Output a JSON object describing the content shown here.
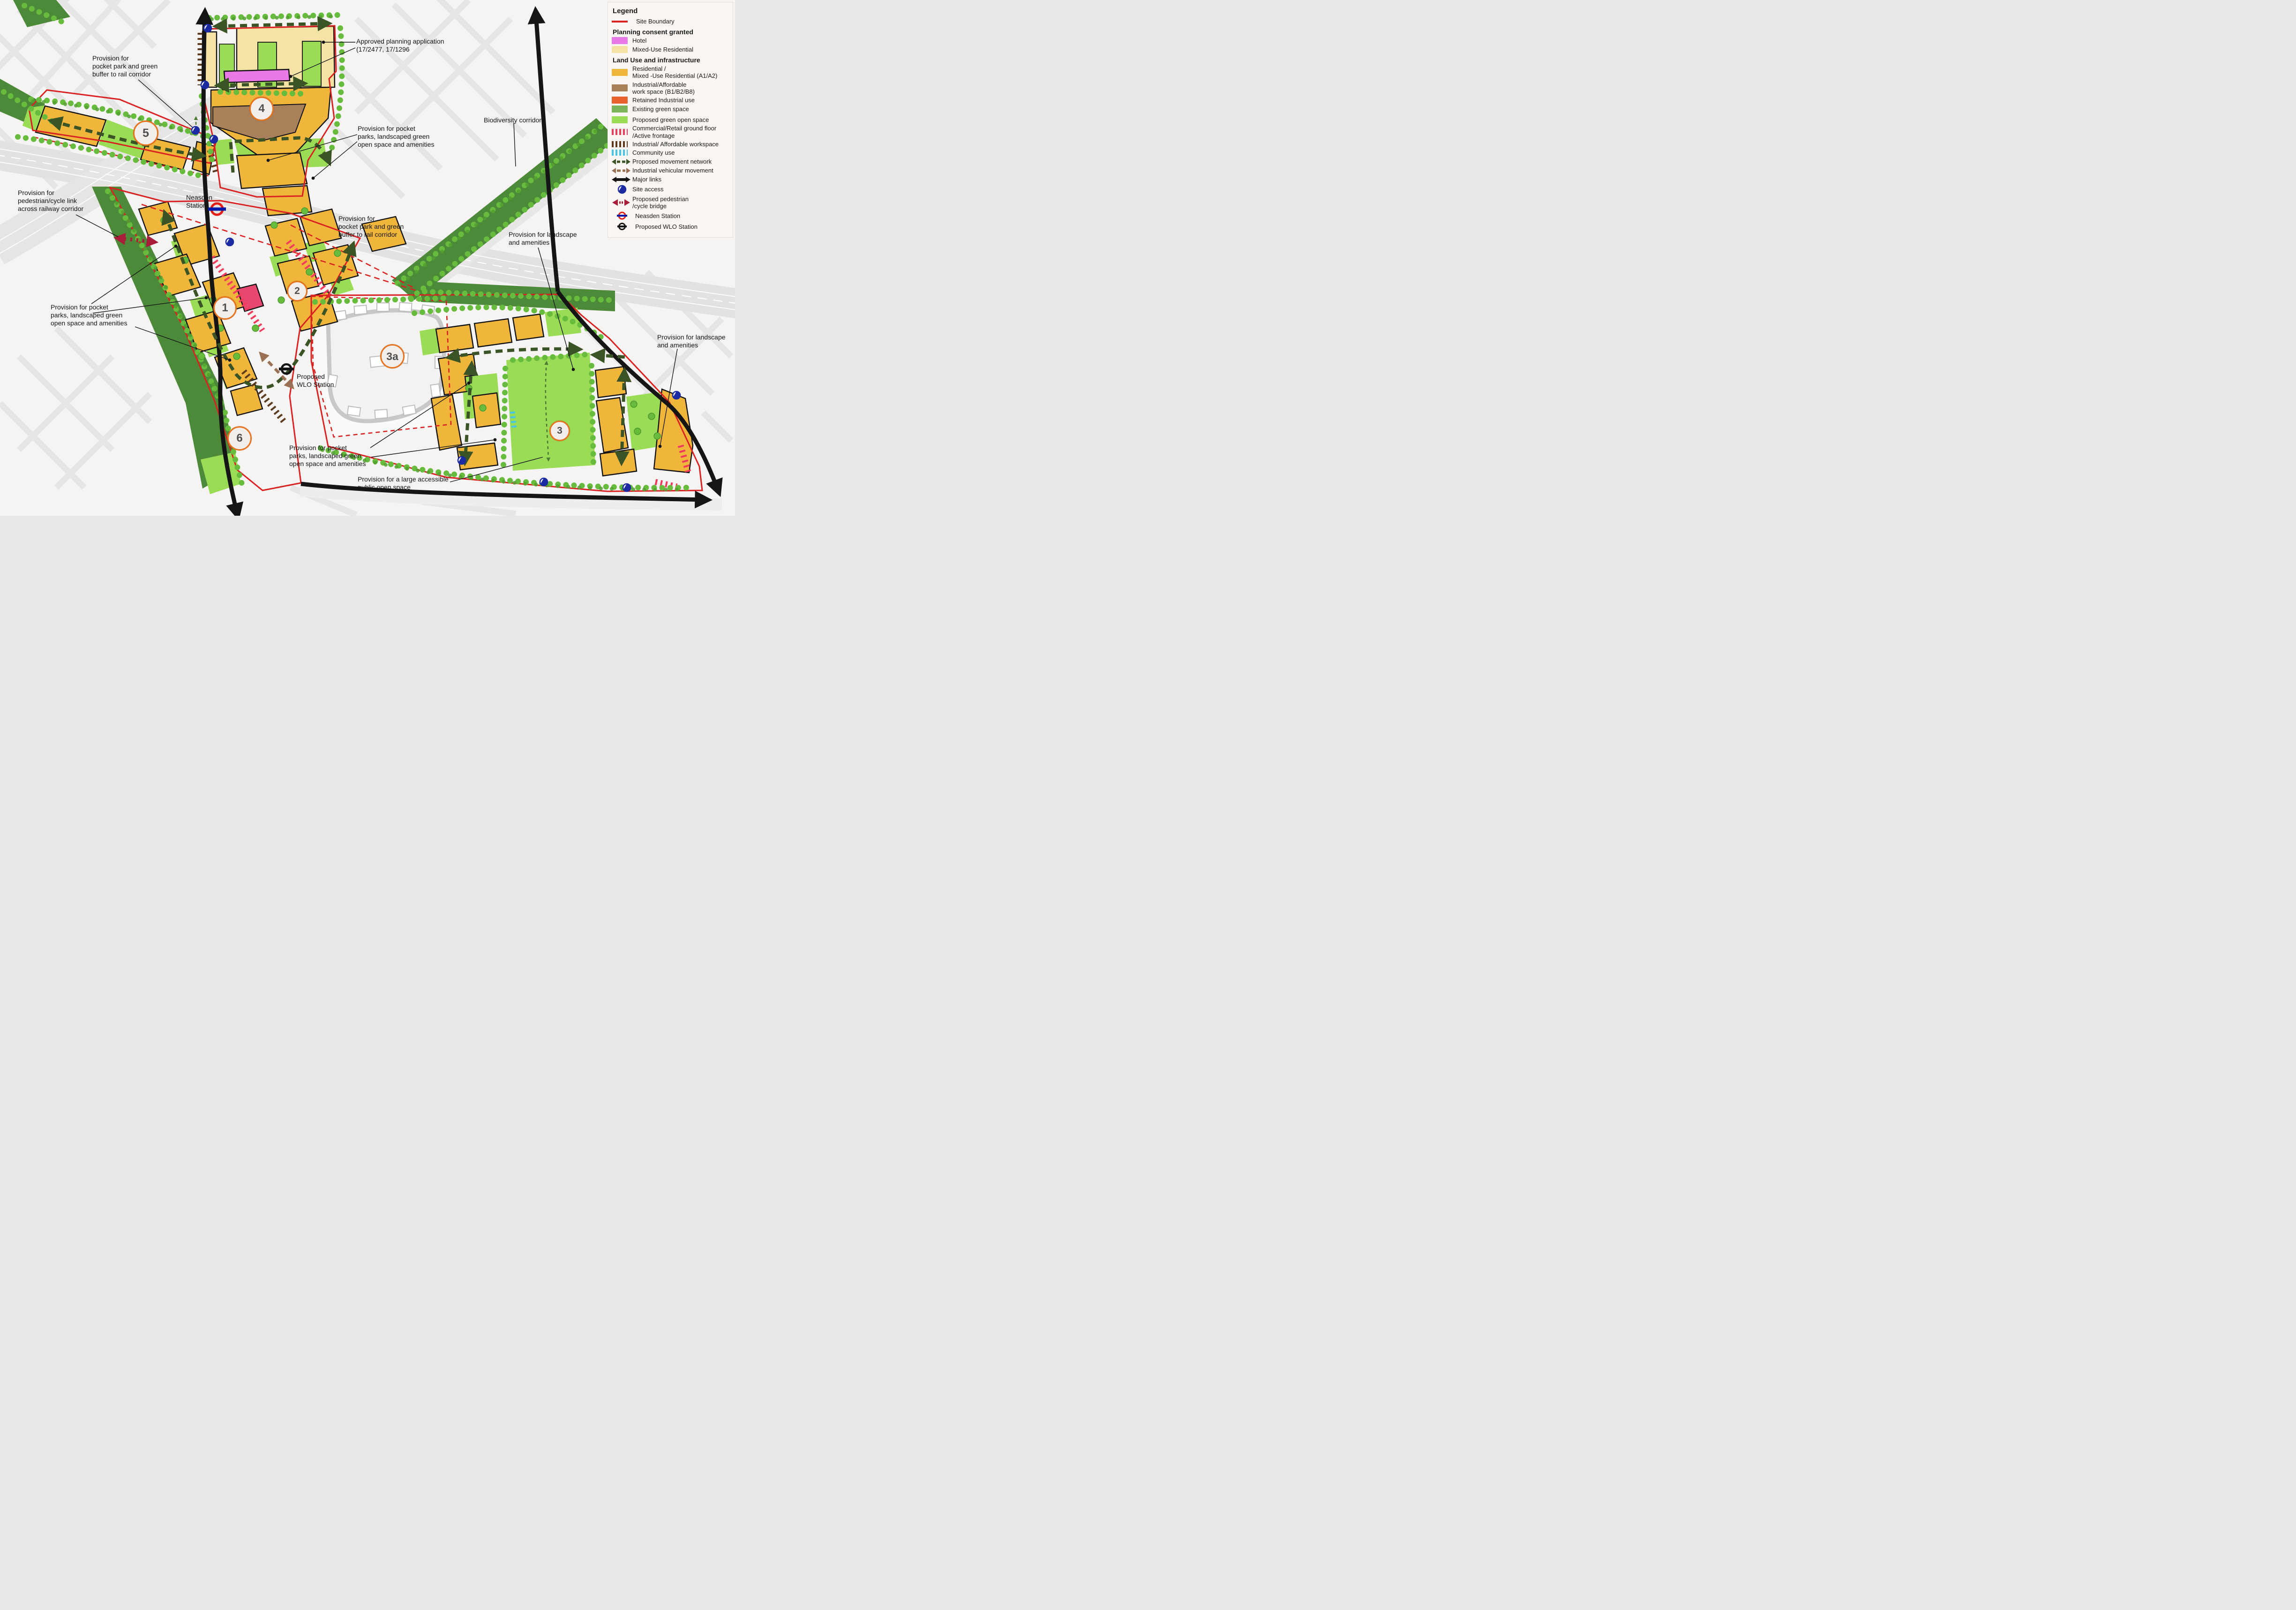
{
  "legend": {
    "title": "Legend",
    "rows": [
      {
        "label": "Site Boundary"
      },
      {
        "label": "Planning consent granted"
      },
      {
        "label": "Hotel"
      },
      {
        "label": "Mixed-Use Residential"
      },
      {
        "label": "Land Use and infrastructure"
      },
      {
        "label": "Residential /\nMixed -Use Residential (A1/A2)"
      },
      {
        "label": "Industrial/Affordable\nwork space (B1/B2/B8)"
      },
      {
        "label": "Retained Industrial use"
      },
      {
        "label": "Existing green space"
      },
      {
        "label": "Proposed green open space"
      },
      {
        "label": "Commercial/Retail ground floor\n/Active frontage"
      },
      {
        "label": "Industrial/ Affordable workspace"
      },
      {
        "label": "Community use"
      },
      {
        "label": "Proposed movement network"
      },
      {
        "label": "Industrial vehicular movement"
      },
      {
        "label": "Major links"
      },
      {
        "label": "Site access"
      },
      {
        "label": "Proposed pedestrian\n/cycle bridge"
      },
      {
        "label": "Neasden Station"
      },
      {
        "label": "Proposed WLO Station"
      }
    ]
  },
  "map": {
    "annotations": {
      "pocket_park_buffer_nw": "Provision for\npocket park and green\nbuffer to rail corridor",
      "approved_planning": "Approved planning application\n(17/2477, 17/1296",
      "pocket_parks_top": "Provision for pocket\nparks, landscaped green\nopen space and amenities",
      "biodiversity": "Biodiversity corridor",
      "ped_cycle_link": "Provision for\npedestrian/cycle link\nacross railway corridor",
      "neasden_station": "Neasden\nStation",
      "pocket_park_buffer_mid": "Provision for\npocket park and green\nbuffer to rail corridor",
      "landscape_amenities_mid": "Provision for landscape\nand amenities",
      "pocket_parks_left": "Provision for pocket\nparks, landscaped green\nopen space and amenities",
      "wlo_station": "Proposed\nWLO Station",
      "landscape_amenities_right": "Provision for landscape\nand amenities",
      "pocket_parks_bottom": "Provision for pocket\nparks, landscaped green\nopen space and amenities",
      "large_open_space": "Provision for a large accessible\npublic open space"
    },
    "areas": [
      {
        "id": "1"
      },
      {
        "id": "2"
      },
      {
        "id": "3"
      },
      {
        "id": "3a"
      },
      {
        "id": "4"
      },
      {
        "id": "5"
      },
      {
        "id": "6"
      }
    ],
    "colors": {
      "site_boundary": "#d92121",
      "hotel": "#ea79e8",
      "mixed_use_residential": "#f5e3a6",
      "residential_mixed_use": "#efb63b",
      "industrial_workspace": "#a8815b",
      "retained_industrial": "#e8632c",
      "existing_green_space": "#4c8a39",
      "proposed_green_open_space": "#9bdc57",
      "commercial_retail_frontage": "#f23b5c",
      "industrial_affordable_frontage": "#5c3a1e",
      "community_use": "#44c7e9",
      "proposed_movement_network": "#3a5426",
      "industrial_vehicular_movement": "#9a7154",
      "major_links": "#151515",
      "site_access": "#1b2aa0",
      "pedestrian_cycle_bridge": "#a81e38",
      "neasden_roundel_red": "#e32017",
      "neasden_roundel_blue": "#0019a8",
      "area_badge_border": "#e8731e"
    }
  }
}
